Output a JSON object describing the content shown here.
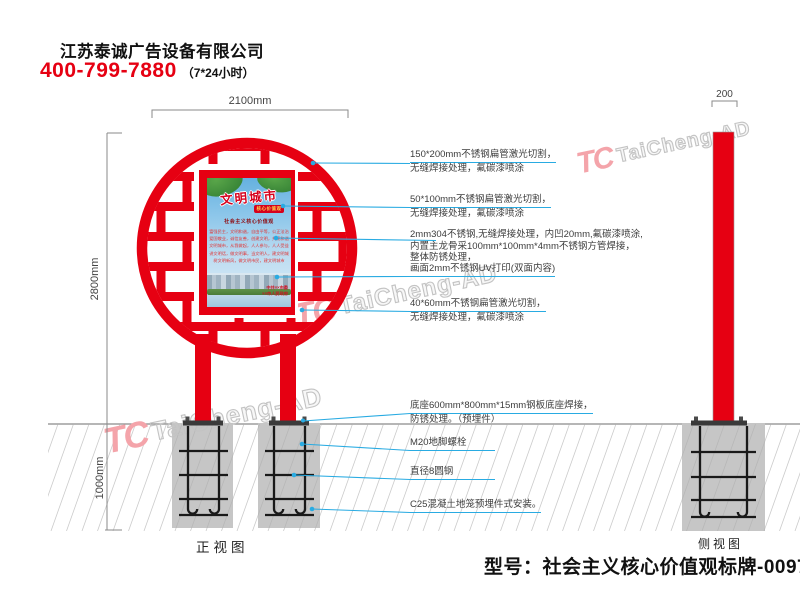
{
  "header": {
    "company": "江苏泰诚广告设备有限公司",
    "phone": "400-799-7880",
    "hours": "（7*24小时）"
  },
  "watermark": {
    "logo": "TC",
    "text": "TaiCheng-AD"
  },
  "dimensions": {
    "sign_width": "2100mm",
    "sign_height": "2800mm",
    "foundation_depth": "1000mm",
    "side_thickness": "200"
  },
  "view_labels": {
    "front": "正视图",
    "side": "侧视图"
  },
  "model_label": "型号：社会主义核心价值观标牌-0097",
  "poster": {
    "title": "文明城市",
    "banner": "核心价值观",
    "headline": "社会主义核心价值观",
    "rows": [
      "富强民主，文明和谐，自由平等，公正法治",
      "爱国敬业，诚信友善，创建文明，共建和谐",
      "文明城市，从我做起，人人参与，人人受益",
      "讲文明话，做文明事，当文明人，建文明城",
      "树文明新风，做文明市民，建文明城市"
    ],
    "footer": [
      "中共××市委",
      "××市人民政府"
    ]
  },
  "annotations": {
    "upper": [
      {
        "lines": [
          "150*200mm不锈钢扁管激光切割，",
          "无缝焊接处理，氟碳漆喷涂"
        ]
      },
      {
        "lines": [
          "50*100mm不锈钢扁管激光切割，",
          "无缝焊接处理，氟碳漆喷涂"
        ]
      },
      {
        "lines": [
          "2mm304不锈钢,无缝焊接处理，内凹20mm,氟碳漆喷涂,",
          "内置主龙骨采100mm*100mm*4mm不锈钢方管焊接，",
          "整体防锈处理，"
        ]
      },
      {
        "lines": [
          "画面2mm不锈钢UV打印(双面内容)"
        ]
      },
      {
        "lines": [
          "40*60mm不锈钢扁管激光切割，",
          "无缝焊接处理，氟碳漆喷涂"
        ]
      }
    ],
    "lower": [
      {
        "lines": [
          "底座600mm*800mm*15mm钢板底座焊接，",
          "防锈处理。（预埋件）"
        ]
      },
      {
        "lines": [
          "M20地脚螺栓"
        ]
      },
      {
        "lines": [
          "直径8圆钢"
        ]
      },
      {
        "lines": [
          "C25混凝土地笼预埋件式安装。"
        ]
      }
    ]
  },
  "colors": {
    "red": "#e60012",
    "callout_blue": "#29abe2",
    "concrete": "#c6c6c6"
  }
}
